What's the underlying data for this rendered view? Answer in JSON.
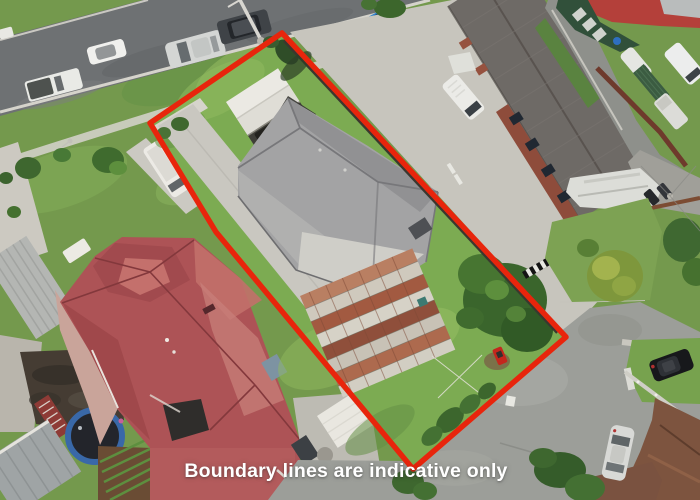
{
  "canvas": {
    "width": 700,
    "height": 500
  },
  "caption": {
    "text": "Boundary lines are indicative only",
    "color": "#ffffff"
  },
  "boundary": {
    "color": "#e8250c",
    "stroke_width": 5.5
  },
  "palette": {
    "asphalt_road": "#6e7173",
    "junction_road": "#9c9e99",
    "lane_concrete": "#c7c5bd",
    "driveway_concrete": "#c9c7c0",
    "lawn": "#7cab52",
    "verge_grass": "#6f9c4c",
    "red_roof": "#ad5356",
    "grey_house_roof": "#a3a3a4",
    "units_roof": "#6e6a66",
    "rust_roof": "#a25a41",
    "white_garage_roof": "#ebe9e3",
    "brick_wall": "#8e4c3b",
    "dark_fence": "#3b372f",
    "trampoline_blue": "#3968a8",
    "tree_green": "#3a652c",
    "brown_roof": "#7d543f"
  }
}
